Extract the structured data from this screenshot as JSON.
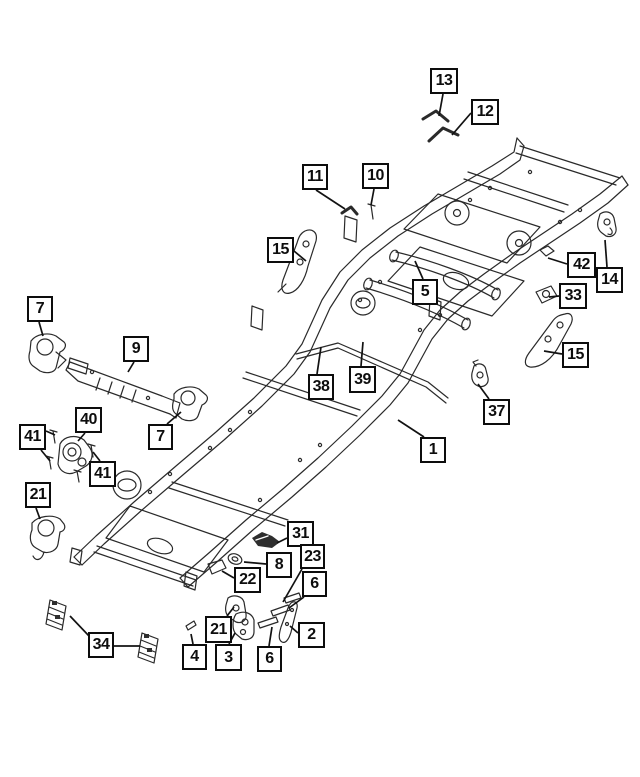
{
  "diagram": {
    "type": "exploded-parts-diagram",
    "subject": "truck frame and chassis components",
    "ink_color": "#2a2a2a",
    "leader_color": "#121212",
    "background_color": "#ffffff",
    "callouts": [
      {
        "label": "13",
        "x": 430,
        "y": 68,
        "w": 28,
        "h": 26,
        "leaders": [
          [
            [
              443,
              94
            ],
            [
              439,
              116
            ]
          ]
        ]
      },
      {
        "label": "12",
        "x": 471,
        "y": 99,
        "w": 28,
        "h": 26,
        "leaders": [
          [
            [
              471,
              113
            ],
            [
              452,
              135
            ]
          ]
        ]
      },
      {
        "label": "11",
        "x": 302,
        "y": 164,
        "w": 26,
        "h": 26,
        "leaders": [
          [
            [
              316,
              190
            ],
            [
              345,
              209
            ]
          ]
        ]
      },
      {
        "label": "10",
        "x": 362,
        "y": 163,
        "w": 27,
        "h": 26,
        "leaders": [
          [
            [
              374,
              189
            ],
            [
              371,
              205
            ]
          ]
        ]
      },
      {
        "label": "15",
        "x": 267,
        "y": 237,
        "w": 27,
        "h": 26,
        "leaders": [
          [
            [
              294,
              251
            ],
            [
              306,
              261
            ]
          ]
        ]
      },
      {
        "label": "5",
        "x": 412,
        "y": 279,
        "w": 26,
        "h": 26,
        "leaders": [
          [
            [
              423,
              279
            ],
            [
              415,
              261
            ]
          ]
        ]
      },
      {
        "label": "42",
        "x": 567,
        "y": 252,
        "w": 29,
        "h": 26,
        "leaders": [
          [
            [
              567,
              264
            ],
            [
              548,
              258
            ]
          ]
        ]
      },
      {
        "label": "14",
        "x": 596,
        "y": 267,
        "w": 27,
        "h": 26,
        "leaders": [
          [
            [
              607,
              267
            ],
            [
              605,
              240
            ]
          ]
        ]
      },
      {
        "label": "33",
        "x": 559,
        "y": 283,
        "w": 28,
        "h": 26,
        "leaders": [
          [
            [
              559,
              296
            ],
            [
              549,
              297
            ]
          ]
        ]
      },
      {
        "label": "15",
        "x": 562,
        "y": 342,
        "w": 27,
        "h": 26,
        "leaders": [
          [
            [
              562,
              354
            ],
            [
              544,
              351
            ]
          ]
        ]
      },
      {
        "label": "37",
        "x": 483,
        "y": 399,
        "w": 27,
        "h": 26,
        "leaders": [
          [
            [
              489,
              399
            ],
            [
              478,
              384
            ]
          ]
        ]
      },
      {
        "label": "1",
        "x": 420,
        "y": 437,
        "w": 26,
        "h": 26,
        "leaders": [
          [
            [
              424,
              437
            ],
            [
              398,
              420
            ]
          ]
        ]
      },
      {
        "label": "7",
        "x": 27,
        "y": 296,
        "w": 26,
        "h": 26,
        "leaders": [
          [
            [
              39,
              322
            ],
            [
              43,
              336
            ]
          ]
        ]
      },
      {
        "label": "9",
        "x": 123,
        "y": 336,
        "w": 26,
        "h": 26,
        "leaders": [
          [
            [
              134,
              362
            ],
            [
              128,
              372
            ]
          ]
        ]
      },
      {
        "label": "38",
        "x": 308,
        "y": 374,
        "w": 26,
        "h": 26,
        "leaders": [
          [
            [
              317,
              374
            ],
            [
              321,
              347
            ]
          ]
        ]
      },
      {
        "label": "39",
        "x": 349,
        "y": 366,
        "w": 27,
        "h": 27,
        "leaders": [
          [
            [
              361,
              366
            ],
            [
              363,
              342
            ]
          ]
        ]
      },
      {
        "label": "40",
        "x": 75,
        "y": 407,
        "w": 27,
        "h": 26,
        "leaders": [
          [
            [
              85,
              433
            ],
            [
              78,
              441
            ]
          ]
        ]
      },
      {
        "label": "41",
        "x": 19,
        "y": 424,
        "w": 27,
        "h": 26,
        "leaders": [
          [
            [
              46,
              431
            ],
            [
              55,
              435
            ]
          ],
          [
            [
              41,
              450
            ],
            [
              50,
              461
            ]
          ]
        ]
      },
      {
        "label": "41",
        "x": 89,
        "y": 461,
        "w": 27,
        "h": 26,
        "leaders": [
          [
            [
              100,
              461
            ],
            [
              93,
              452
            ]
          ]
        ]
      },
      {
        "label": "7",
        "x": 148,
        "y": 424,
        "w": 25,
        "h": 26,
        "leaders": [
          [
            [
              167,
              424
            ],
            [
              181,
              412
            ]
          ]
        ]
      },
      {
        "label": "21",
        "x": 25,
        "y": 482,
        "w": 26,
        "h": 26,
        "leaders": [
          [
            [
              36,
              508
            ],
            [
              40,
              519
            ]
          ]
        ]
      },
      {
        "label": "31",
        "x": 287,
        "y": 521,
        "w": 27,
        "h": 26,
        "leaders": [
          [
            [
              287,
              538
            ],
            [
              277,
              543
            ]
          ]
        ]
      },
      {
        "label": "23",
        "x": 300,
        "y": 544,
        "w": 25,
        "h": 25,
        "leaders": [
          [
            [
              302,
              569
            ],
            [
              283,
              602
            ]
          ]
        ]
      },
      {
        "label": "8",
        "x": 266,
        "y": 552,
        "w": 26,
        "h": 26,
        "leaders": [
          [
            [
              266,
              564
            ],
            [
              244,
              562
            ]
          ]
        ]
      },
      {
        "label": "22",
        "x": 234,
        "y": 567,
        "w": 27,
        "h": 26,
        "leaders": [
          [
            [
              234,
              578
            ],
            [
              222,
              571
            ]
          ]
        ]
      },
      {
        "label": "6",
        "x": 302,
        "y": 571,
        "w": 25,
        "h": 26,
        "leaders": [
          [
            [
              304,
              597
            ],
            [
              289,
              608
            ]
          ]
        ]
      },
      {
        "label": "2",
        "x": 298,
        "y": 622,
        "w": 27,
        "h": 26,
        "leaders": [
          [
            [
              298,
              633
            ],
            [
              290,
              626
            ]
          ]
        ]
      },
      {
        "label": "21",
        "x": 205,
        "y": 616,
        "w": 27,
        "h": 27,
        "leaders": [
          [
            [
              227,
              616
            ],
            [
              234,
              607
            ]
          ]
        ]
      },
      {
        "label": "4",
        "x": 182,
        "y": 644,
        "w": 25,
        "h": 26,
        "leaders": [
          [
            [
              193,
              644
            ],
            [
              191,
              634
            ]
          ]
        ]
      },
      {
        "label": "3",
        "x": 215,
        "y": 644,
        "w": 27,
        "h": 27,
        "leaders": [
          [
            [
              229,
              644
            ],
            [
              235,
              633
            ]
          ]
        ]
      },
      {
        "label": "6",
        "x": 257,
        "y": 646,
        "w": 25,
        "h": 26,
        "leaders": [
          [
            [
              269,
              646
            ],
            [
              272,
              627
            ]
          ]
        ]
      },
      {
        "label": "34",
        "x": 88,
        "y": 632,
        "w": 26,
        "h": 26,
        "leaders": [
          [
            [
              89,
              636
            ],
            [
              70,
              616
            ]
          ],
          [
            [
              114,
              646
            ],
            [
              140,
              646
            ]
          ]
        ]
      }
    ]
  }
}
